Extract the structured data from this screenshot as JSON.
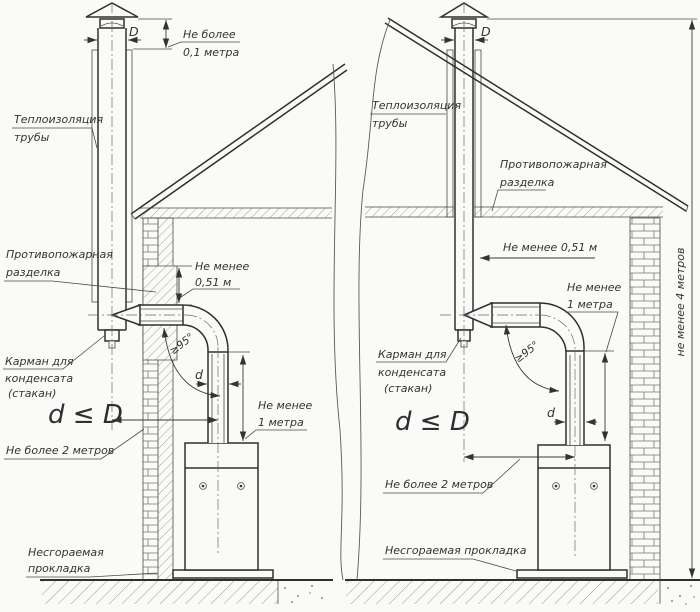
{
  "colors": {
    "ink": "#2f2f2f",
    "paper": "#fafaf8",
    "hatch": "#8a8a8a"
  },
  "left": {
    "top_dim_l1": "Не более",
    "top_dim_l2": "0,1 метра",
    "dia": "D",
    "insul_l1": "Теплоизоляция",
    "insul_l2": "трубы",
    "fire_l1": "Противопожарная",
    "fire_l2": "разделка",
    "gap_l1": "Не менее",
    "gap_l2": "0,51 м",
    "pocket_l1": "Карман для",
    "pocket_l2": "конденсата",
    "pocket_l3": "(стакан)",
    "formula": "d ≤ D",
    "run_max": "Не более 2 метров",
    "angle": "≥95°",
    "dia_small": "d",
    "drop_l1": "Не менее",
    "drop_l2": "1 метра",
    "pad_l1": "Несгораемая",
    "pad_l2": "прокладка"
  },
  "right": {
    "dia": "D",
    "insul_l1": "Теплоизоляция",
    "insul_l2": "трубы",
    "fire_l1": "Противопожарная",
    "fire_l2": "разделка",
    "gap": "Не менее 0,51 м",
    "pocket_l1": "Карман для",
    "pocket_l2": "конденсата",
    "pocket_l3": "(стакан)",
    "formula": "d ≤ D",
    "run_max": "Не более 2 метров",
    "angle": "≥95°",
    "dia_small": "d",
    "drop_l1": "Не менее",
    "drop_l2": "1 метра",
    "pad": "Несгораемая прокладка",
    "height_min": "не менее 4 метров"
  }
}
